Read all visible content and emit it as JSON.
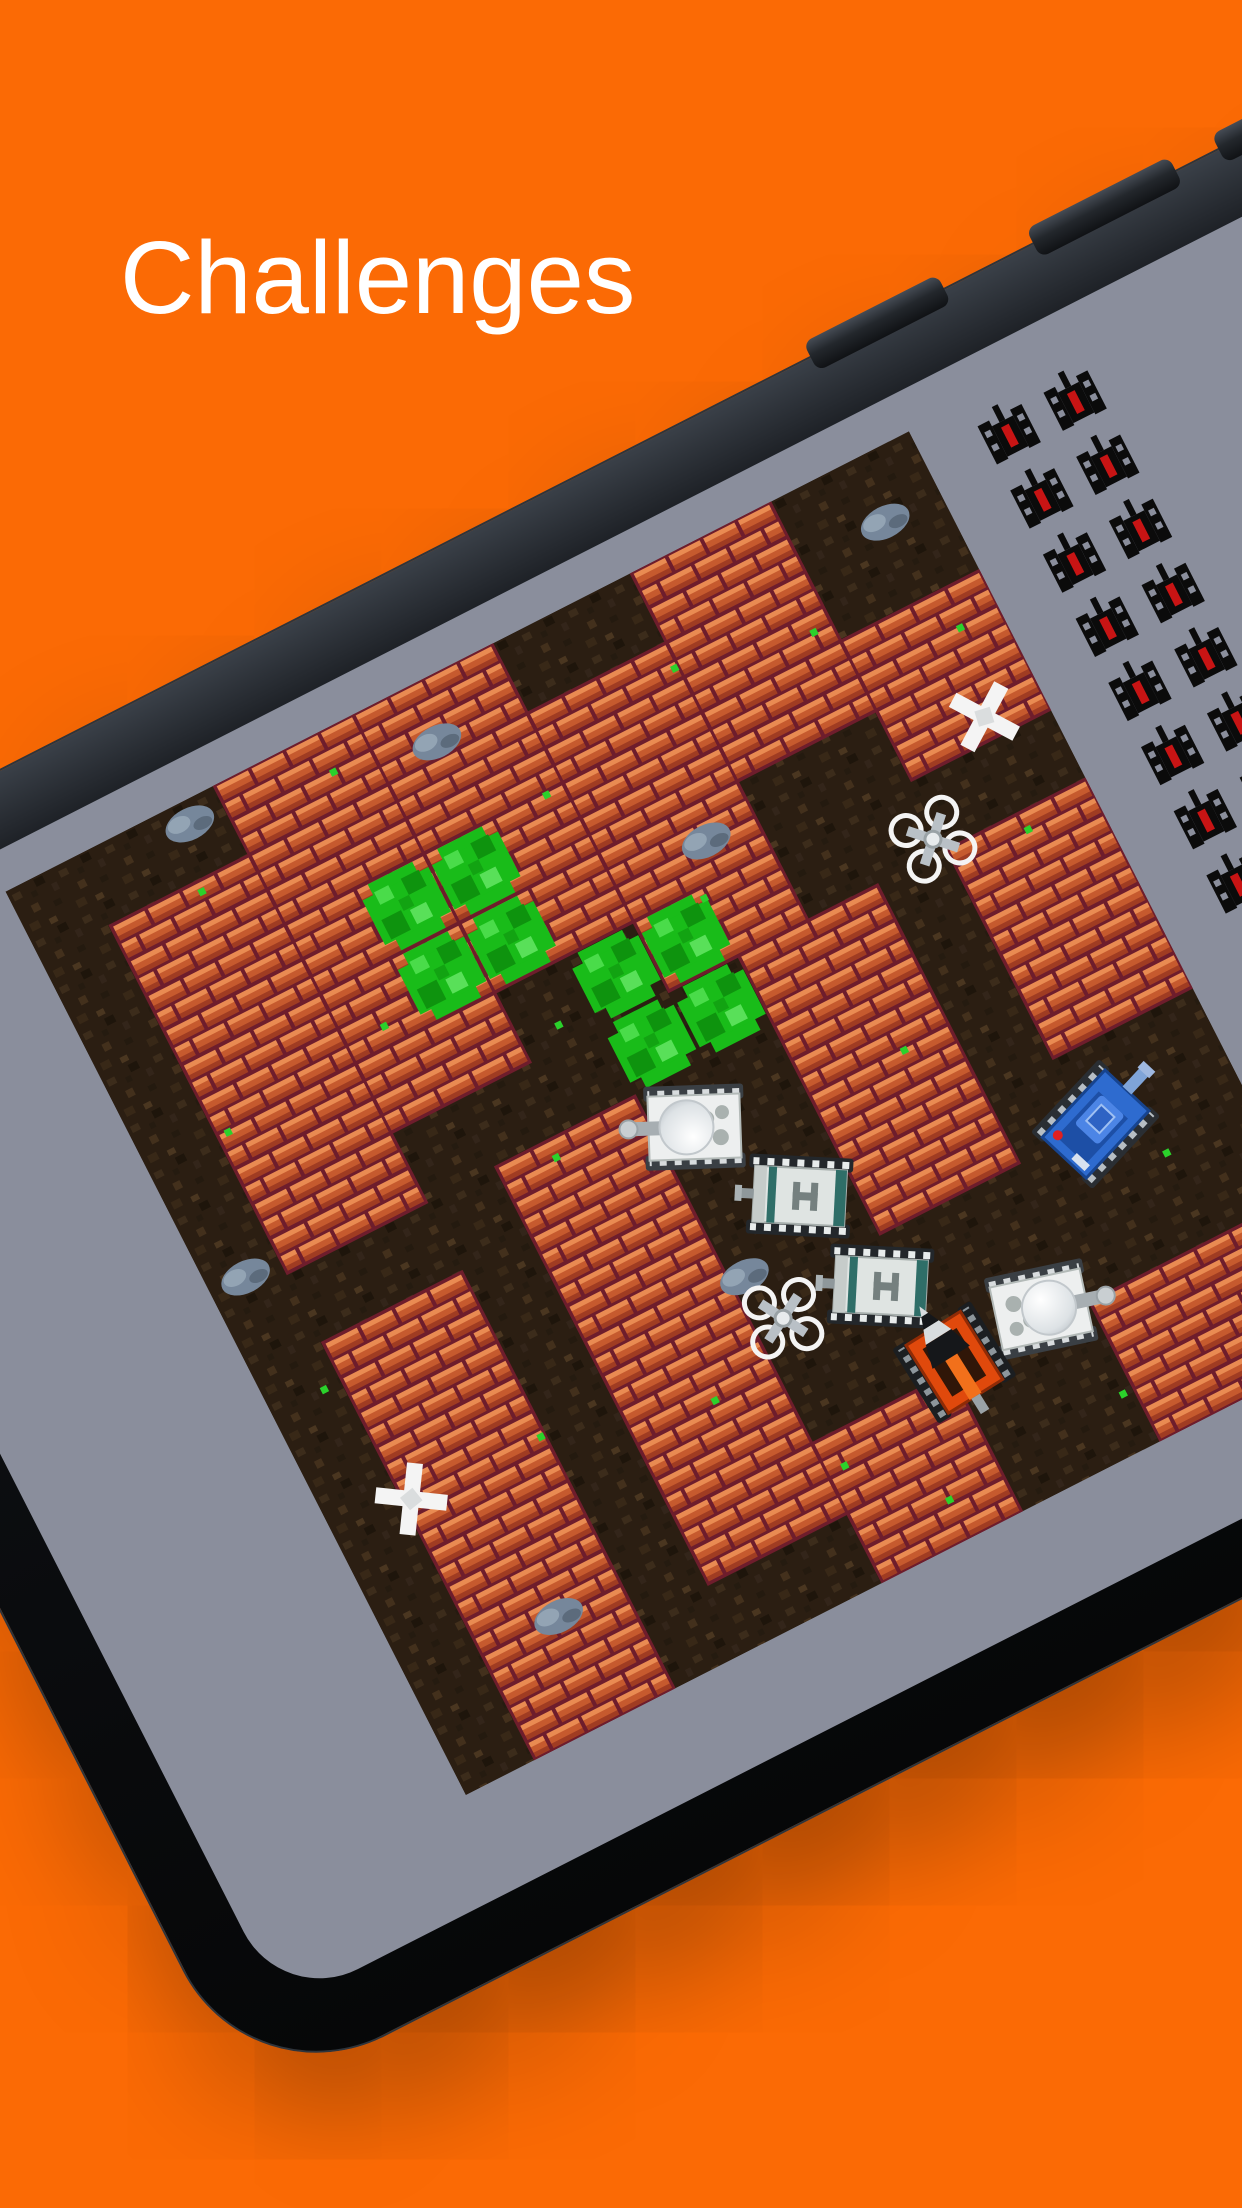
{
  "title": {
    "text": "Challenges"
  },
  "colors": {
    "background": "#FB6A05",
    "title_text": "#FFFFFF",
    "phone_body": "#0D0F12",
    "phone_edge_highlight": "#3A4048",
    "screen": "#8A8E9C",
    "dirt_base": "#2B1E12",
    "brick_face": "#C65A2E",
    "brick_highlight": "#E98B52",
    "brick_shadow": "#A03C22",
    "brick_mortar": "#6E1D2C",
    "bush_green": "#17B417",
    "stone_gray": "#8494A3",
    "grass_dot": "#2BD12B",
    "enemy_icon_body": "#0B0B0B",
    "enemy_icon_core": "#C81414"
  },
  "hud": {
    "enemy_icons_remaining": 16,
    "columns": 2,
    "icon_name": "enemy-tank-icon"
  },
  "game": {
    "grid_size": 13,
    "tile_px": 78,
    "bricks": [
      {
        "x": 1,
        "y": 1,
        "w": 2,
        "h": 5
      },
      {
        "x": 3,
        "y": 0,
        "w": 2,
        "h": 5
      },
      {
        "x": 5,
        "y": 0,
        "w": 2,
        "h": 4
      },
      {
        "x": 7,
        "y": 1,
        "w": 2,
        "h": 4
      },
      {
        "x": 9,
        "y": 0,
        "w": 2,
        "h": 3
      },
      {
        "x": 11,
        "y": 2,
        "w": 2,
        "h": 2
      },
      {
        "x": 1,
        "y": 7,
        "w": 2,
        "h": 6
      },
      {
        "x": 4,
        "y": 6,
        "w": 2,
        "h": 6
      },
      {
        "x": 8,
        "y": 5,
        "w": 2,
        "h": 4
      },
      {
        "x": 11,
        "y": 5,
        "w": 2,
        "h": 3
      },
      {
        "x": 6,
        "y": 11,
        "w": 2,
        "h": 2
      },
      {
        "x": 10,
        "y": 11,
        "w": 3,
        "h": 2
      }
    ],
    "bushes": [
      {
        "x": 4,
        "y": 2
      },
      {
        "x": 6,
        "y": 4
      }
    ],
    "stones": [
      {
        "x": 2.5,
        "y": 0.3
      },
      {
        "x": 5.8,
        "y": 0.8
      },
      {
        "x": 8.3,
        "y": 3.5
      },
      {
        "x": 0.5,
        "y": 5.8
      },
      {
        "x": 6.2,
        "y": 8.7
      },
      {
        "x": 2.1,
        "y": 11.5
      },
      {
        "x": 9.5,
        "y": 11.1
      },
      {
        "x": 12.2,
        "y": 0.9
      }
    ],
    "dots": [
      {
        "x": 2.2,
        "y": 1.1
      },
      {
        "x": 4.4,
        "y": 0.5
      },
      {
        "x": 6.7,
        "y": 2.0
      },
      {
        "x": 8.9,
        "y": 1.3
      },
      {
        "x": 10.7,
        "y": 1.7
      },
      {
        "x": 12.4,
        "y": 2.5
      },
      {
        "x": 1.1,
        "y": 4.0
      },
      {
        "x": 5.5,
        "y": 4.7
      },
      {
        "x": 7.9,
        "y": 4.1
      },
      {
        "x": 12.0,
        "y": 5.2
      },
      {
        "x": 0.7,
        "y": 7.5
      },
      {
        "x": 4.7,
        "y": 6.2
      },
      {
        "x": 9.3,
        "y": 7.0
      },
      {
        "x": 2.9,
        "y": 9.3
      },
      {
        "x": 6.2,
        "y": 11.4
      },
      {
        "x": 9.8,
        "y": 12.2
      },
      {
        "x": 11.7,
        "y": 9.7
      },
      {
        "x": 3.5,
        "y": 3.7
      },
      {
        "x": 7.2,
        "y": 12.4
      },
      {
        "x": 5.1,
        "y": 9.9
      }
    ],
    "sprites": [
      {
        "type": "tank-ball",
        "name": "white-ball-tank",
        "x": 6.0,
        "y": 6.2,
        "rot": 205
      },
      {
        "type": "tank-h",
        "name": "apc-tank-h",
        "x": 6.8,
        "y": 7.6,
        "rot": 210
      },
      {
        "type": "tank-h",
        "name": "apc-tank-h",
        "x": 7.2,
        "y": 9.1,
        "rot": 210
      },
      {
        "type": "drone",
        "name": "quadcopter-drone",
        "x": 5.9,
        "y": 8.9,
        "rot": 15
      },
      {
        "type": "drone",
        "name": "quadcopter-drone",
        "x": 10.4,
        "y": 4.3,
        "rot": 0
      },
      {
        "type": "tank-blue",
        "name": "blue-player-tank",
        "x": 10.6,
        "y": 8.5,
        "rot": -20
      },
      {
        "type": "tank-ball",
        "name": "white-ball-tank",
        "x": 8.9,
        "y": 10.3,
        "rot": 15
      },
      {
        "type": "excavator",
        "name": "excavator-drill-tank",
        "x": 7.6,
        "y": 10.4,
        "rot": -95
      },
      {
        "type": "wreck",
        "name": "destroyed-wreck",
        "x": 11.7,
        "y": 3.2,
        "rot": 10
      },
      {
        "type": "wreck",
        "name": "destroyed-wreck",
        "x": 0.6,
        "y": 8.8,
        "rot": -12
      }
    ]
  }
}
